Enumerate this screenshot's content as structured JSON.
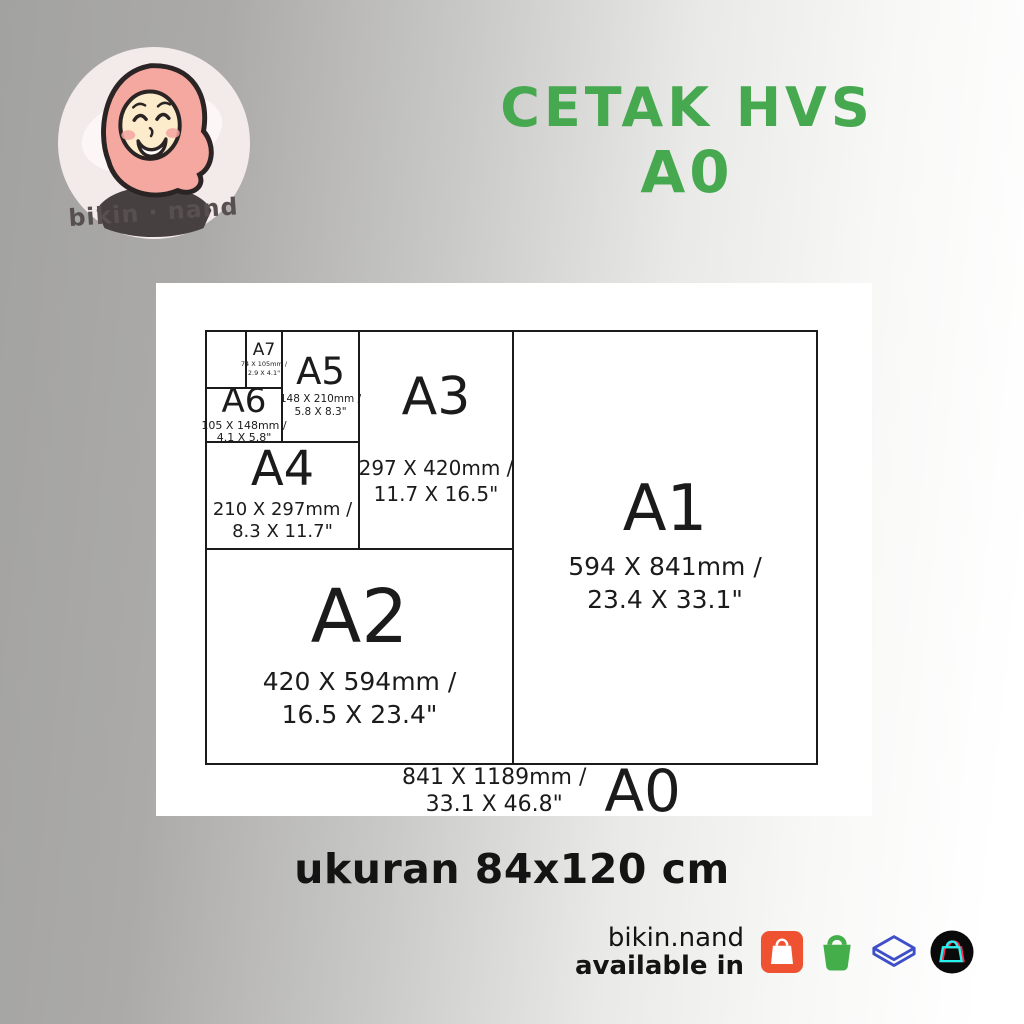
{
  "logo": {
    "text": "bikin · nand"
  },
  "title": {
    "line1": "CETAK HVS",
    "line2": "A0"
  },
  "chart": {
    "a7": {
      "label": "A7",
      "mm": "74 X 105mm /",
      "inch": "2.9 X 4.1\""
    },
    "a6": {
      "label": "A6",
      "mm": "105 X 148mm /",
      "inch": "4.1 X 5.8\""
    },
    "a5": {
      "label": "A5",
      "mm": "148 X 210mm /",
      "inch": "5.8 X 8.3\""
    },
    "a4": {
      "label": "A4",
      "mm": "210 X 297mm /",
      "inch": "8.3 X 11.7\""
    },
    "a3": {
      "label": "A3",
      "mm": "297 X 420mm /",
      "inch": "11.7 X 16.5\""
    },
    "a2": {
      "label": "A2",
      "mm": "420 X 594mm /",
      "inch": "16.5 X 23.4\""
    },
    "a1": {
      "label": "A1",
      "mm": "594 X 841mm /",
      "inch": "23.4 X 33.1\""
    },
    "a0": {
      "label": "A0",
      "mm": "841 X 1189mm /",
      "inch": "33.1 X 46.8\""
    }
  },
  "size_note": "ukuran 84x120 cm",
  "footer": {
    "brand": "bikin.nand",
    "available_in": "available in",
    "icons": [
      "shopee",
      "tokopedia",
      "lazada-chevron",
      "tiktok-shop"
    ]
  },
  "colors": {
    "title_green": "#46a84f",
    "shopee_orange": "#ee5230",
    "tokopedia_green": "#44ae4b",
    "chevron_blue": "#3f4fc8",
    "tiktok_cyan": "#25f4ee",
    "tiktok_pink": "#fe2c55"
  }
}
